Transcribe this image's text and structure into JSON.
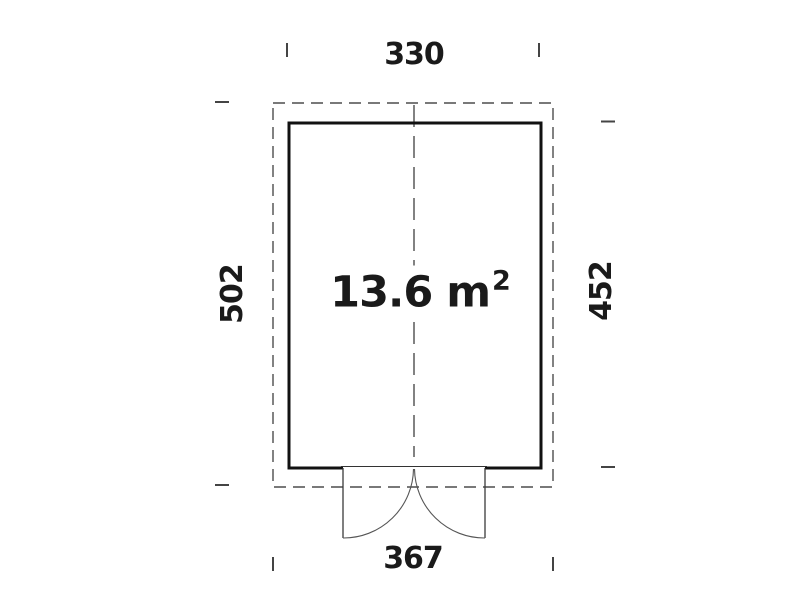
{
  "floor_plan": {
    "area_value": "13.6 m",
    "area_superscript": "2",
    "dimension_top": "330",
    "dimension_left": "502",
    "dimension_right": "452",
    "dimension_bottom": "367"
  },
  "colors": {
    "background": "#ffffff",
    "wall_line": "#111111",
    "dashed_line": "#4d4d4d",
    "thin_line": "#555555",
    "tick_line": "#444444",
    "text": "#1a1a1a"
  }
}
